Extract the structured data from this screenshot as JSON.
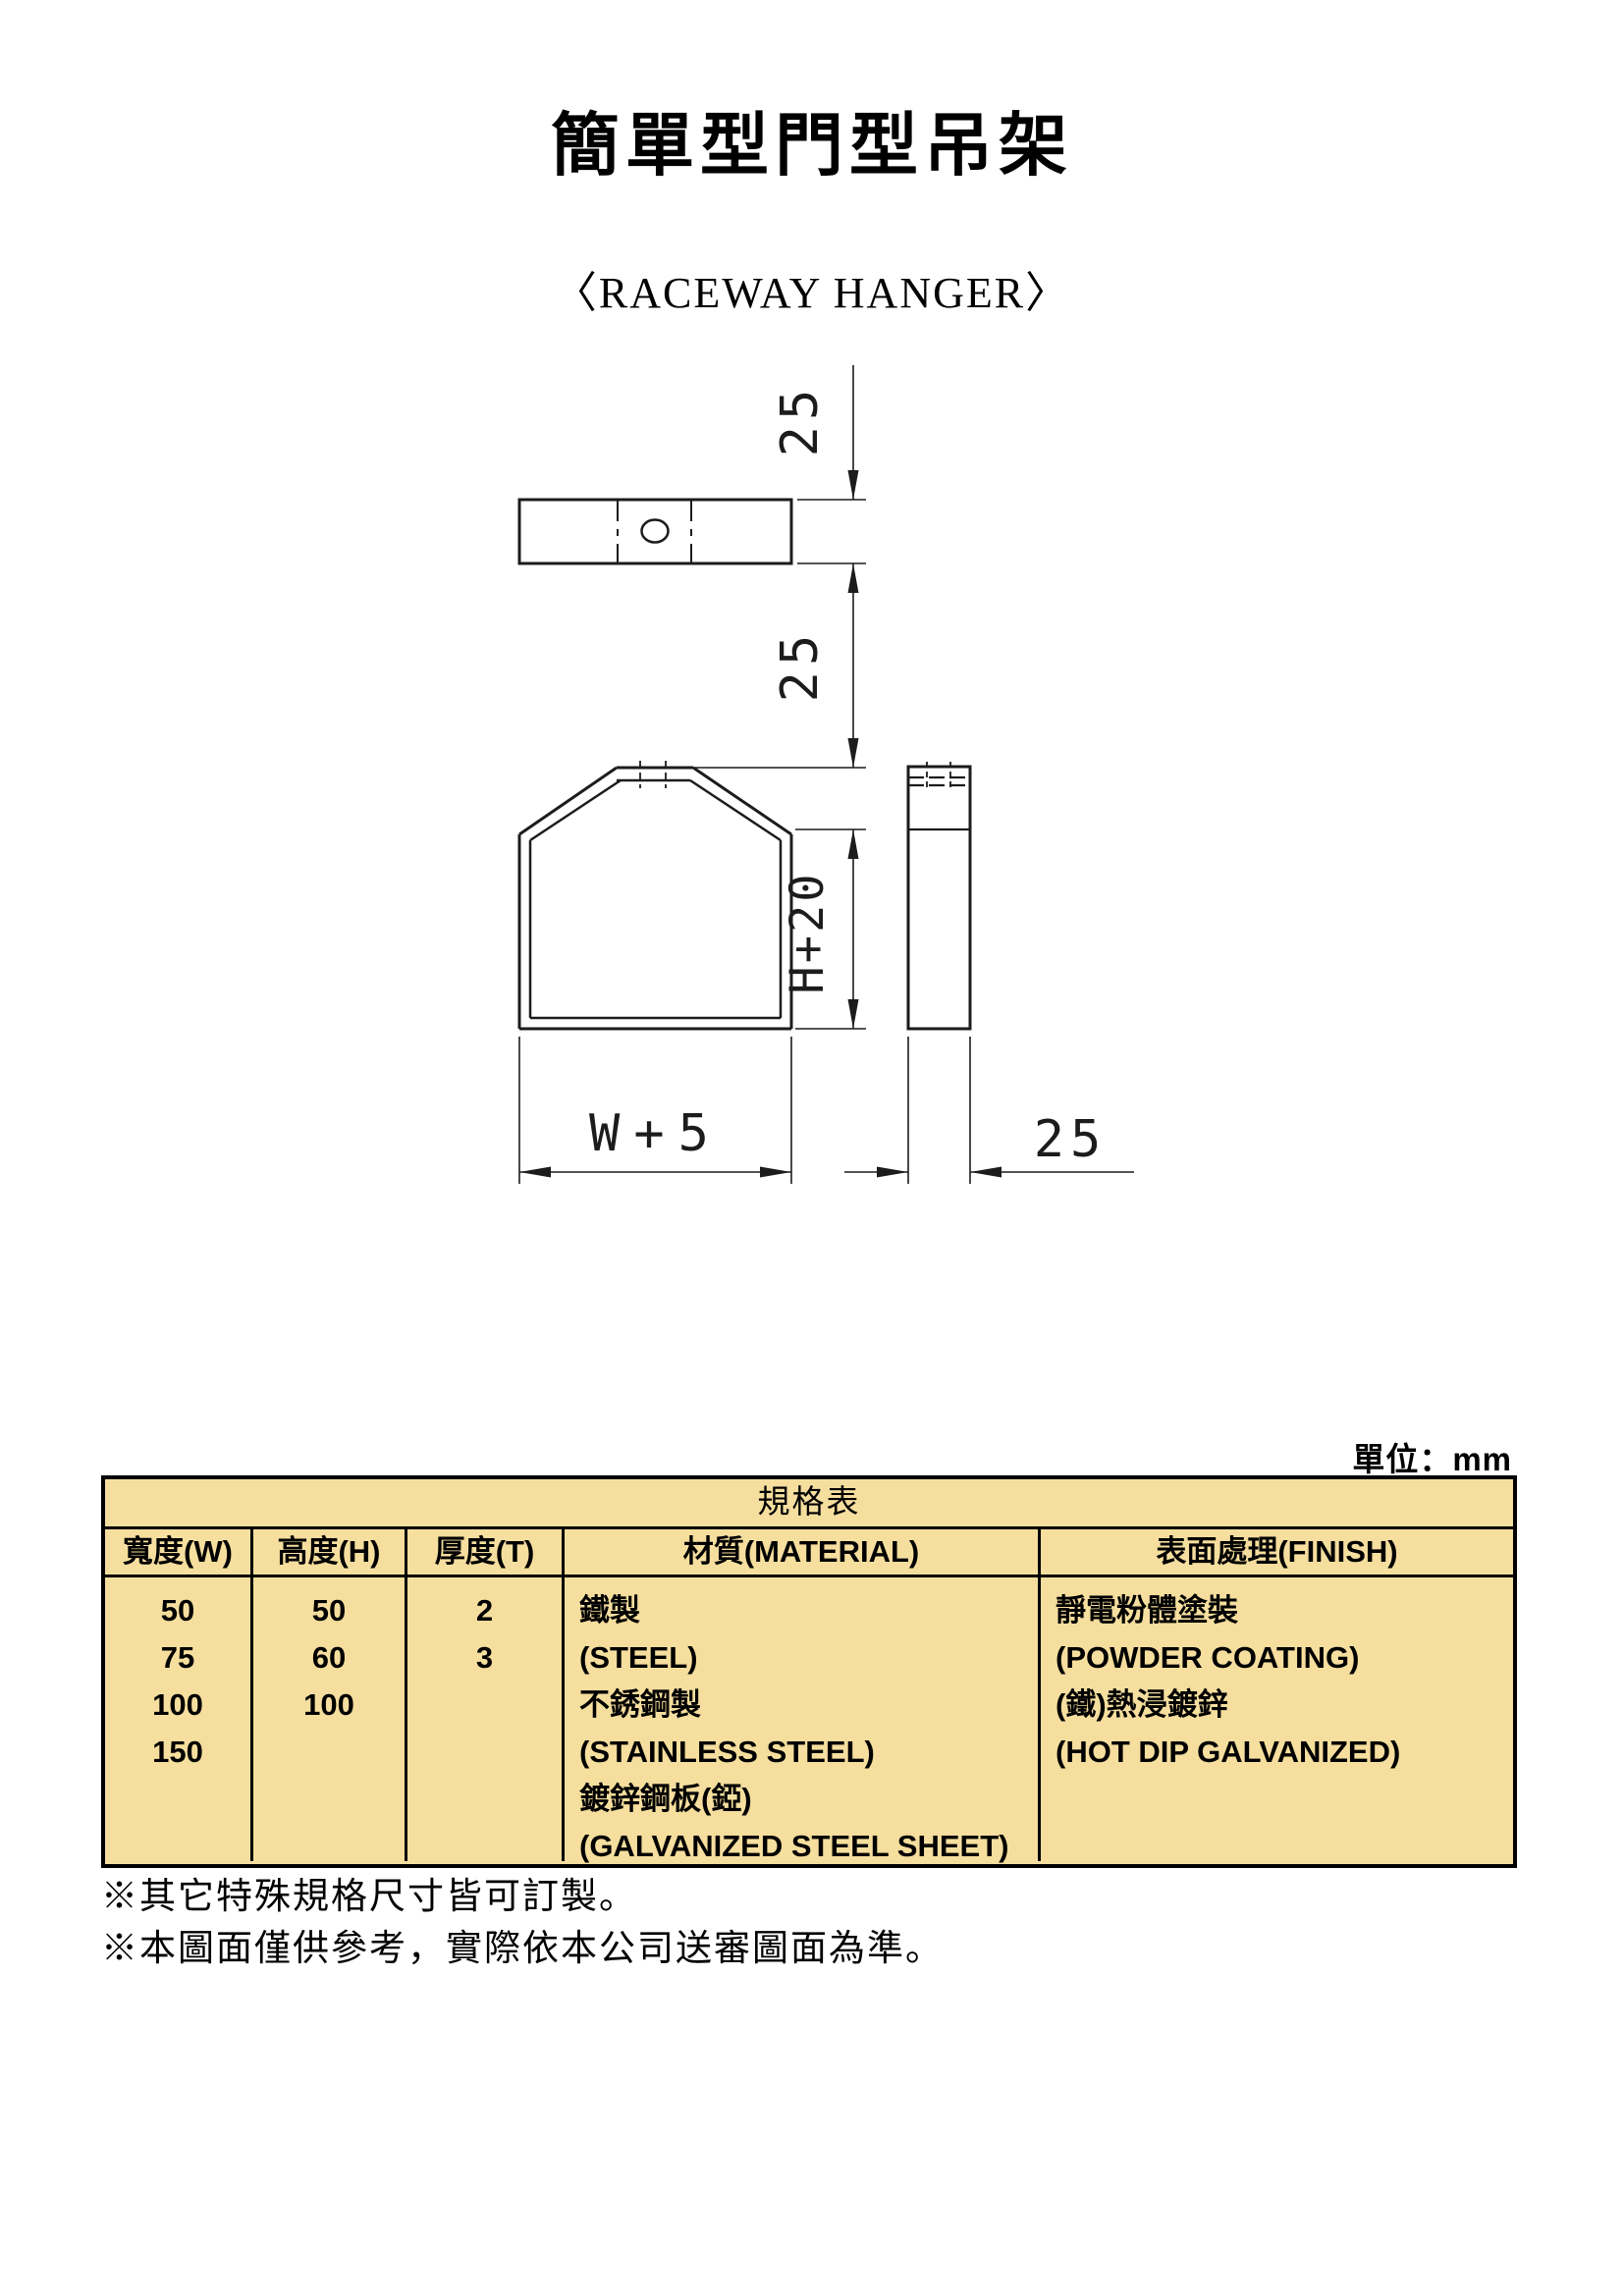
{
  "page": {
    "title": "簡單型門型吊架",
    "subtitle": "〈RACEWAY HANGER〉",
    "unit_label": "單位：mm"
  },
  "drawing": {
    "dims": {
      "bar_thickness": "25",
      "top_offset": "25",
      "body_height": "H+20",
      "body_width": "W+5",
      "side_width": "25"
    },
    "line_color": "#1c1c1c"
  },
  "table": {
    "title": "規格表",
    "bg_color": "#F5DE9E",
    "headers": [
      "寬度(W)",
      "高度(H)",
      "厚度(T)",
      "材質(MATERIAL)",
      "表面處理(FINISH)"
    ],
    "width_values": [
      "50",
      "75",
      "100",
      "150"
    ],
    "height_values": [
      "50",
      "60",
      "100"
    ],
    "thickness_values": [
      "2",
      "3"
    ],
    "material_lines": [
      "鐵製",
      "(STEEL)",
      "不銹鋼製",
      "(STAINLESS STEEL)",
      "鍍鋅鋼板(錏)",
      "(GALVANIZED STEEL SHEET)"
    ],
    "finish_lines": [
      "靜電粉體塗裝",
      "(POWDER COATING)",
      "(鐵)熱浸鍍鋅",
      "(HOT DIP GALVANIZED)"
    ]
  },
  "notes": [
    "※其它特殊規格尺寸皆可訂製。",
    "※本圖面僅供參考，實際依本公司送審圖面為準。"
  ]
}
